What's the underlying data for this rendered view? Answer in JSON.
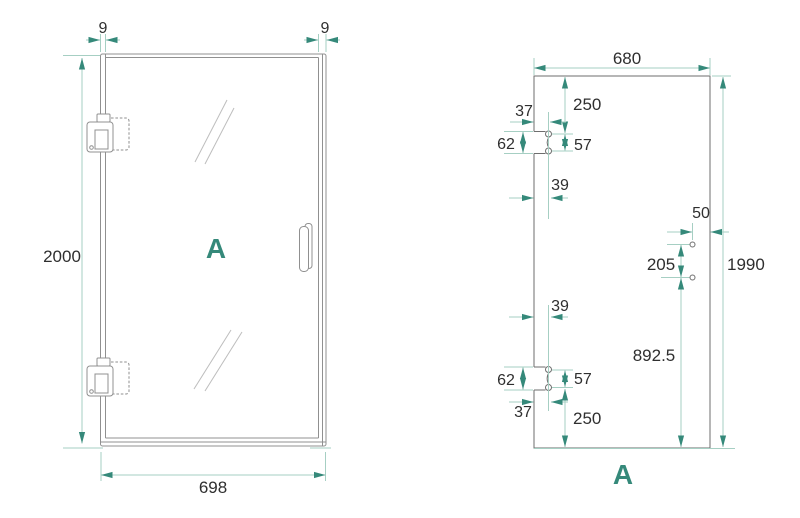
{
  "front_view": {
    "frame_thickness_left": "9",
    "frame_thickness_right": "9",
    "door_height": "2000",
    "door_width": "698",
    "panel_label": "A"
  },
  "glass_panel_view": {
    "glass_width": "680",
    "glass_height": "1990",
    "top_hinge_cutout": {
      "from_top": "250",
      "edge_offset": "37",
      "cutout_height": "62",
      "hole_spacing": "57",
      "depth": "39"
    },
    "bottom_hinge_cutout": {
      "depth": "39",
      "cutout_height": "62",
      "hole_spacing": "57",
      "edge_offset": "37",
      "from_bottom": "250"
    },
    "handle_holes": {
      "edge_distance": "50",
      "hole_spacing": "205",
      "from_bottom": "892.5"
    },
    "panel_label": "A"
  },
  "colors": {
    "accent_teal": "#35897a",
    "dimension_line_teal": "#a6cfc3",
    "drawing_gray": "#8a8a8a",
    "text_dark": "#2f2f2f",
    "background": "#ffffff"
  }
}
